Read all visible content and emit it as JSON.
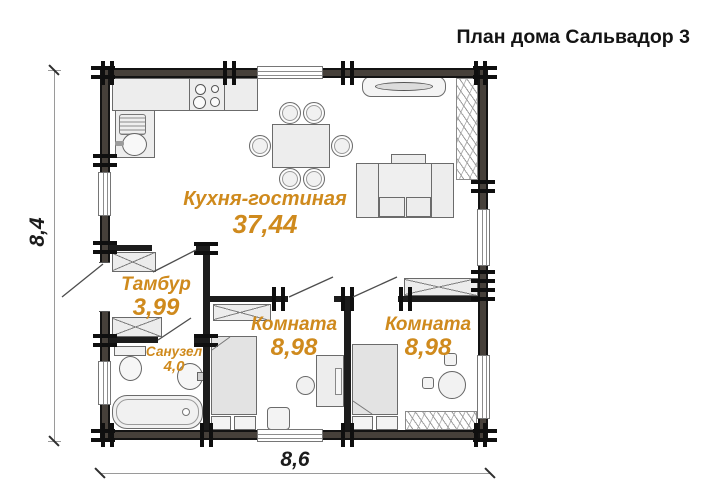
{
  "title": "План дома Сальвадор 3",
  "dimensions": {
    "height": "8,4",
    "width": "8,6"
  },
  "rooms": {
    "living": {
      "name": "Кухня-гостиная",
      "area": "37,44"
    },
    "hall": {
      "name": "Тамбур",
      "area": "3,99"
    },
    "bathroom": {
      "name": "Санузел",
      "area": "4,0"
    },
    "bedroom1": {
      "name": "Комната",
      "area": "8,98"
    },
    "bedroom2": {
      "name": "Комната",
      "area": "8,98"
    }
  },
  "colors": {
    "room_label": "#cf8a1d",
    "wall": "#46403a",
    "wall_edge": "#131313",
    "title_text": "#141414"
  }
}
